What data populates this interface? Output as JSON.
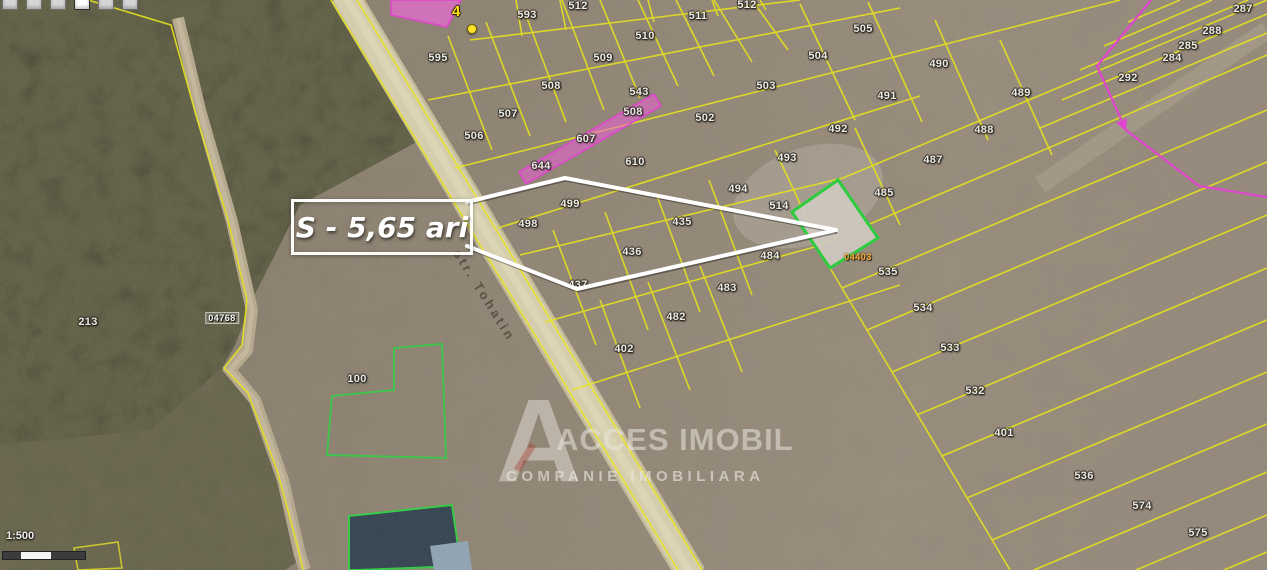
{
  "toolbar": {
    "buttons": [
      {
        "active": false
      },
      {
        "active": false
      },
      {
        "active": false
      },
      {
        "active": true
      },
      {
        "active": false
      },
      {
        "active": false
      }
    ]
  },
  "map": {
    "annotation": {
      "text": "S - 5,65 ari"
    },
    "street_label": {
      "text": "str. Tohatin"
    },
    "marker": {
      "text": "4"
    },
    "scale": {
      "label": "1:500"
    },
    "watermark": {
      "logo_letter": "A",
      "title": "ACCES IMOBIL",
      "subtitle": "COMPANIE IMOBILIARA"
    },
    "cadastral_labels": [
      {
        "text": "04768",
        "x": 222,
        "y": 318,
        "style": "chip"
      },
      {
        "text": "04403",
        "x": 858,
        "y": 257,
        "style": "orange"
      }
    ],
    "parcel_labels": [
      {
        "text": "593",
        "x": 527,
        "y": 15
      },
      {
        "text": "512",
        "x": 578,
        "y": 6
      },
      {
        "text": "511",
        "x": 698,
        "y": 16
      },
      {
        "text": "512",
        "x": 747,
        "y": 5
      },
      {
        "text": "510",
        "x": 645,
        "y": 36
      },
      {
        "text": "509",
        "x": 603,
        "y": 58
      },
      {
        "text": "595",
        "x": 438,
        "y": 58
      },
      {
        "text": "508",
        "x": 551,
        "y": 86
      },
      {
        "text": "543",
        "x": 639,
        "y": 92
      },
      {
        "text": "507",
        "x": 508,
        "y": 114
      },
      {
        "text": "506",
        "x": 474,
        "y": 136
      },
      {
        "text": "508",
        "x": 633,
        "y": 112
      },
      {
        "text": "607",
        "x": 586,
        "y": 139
      },
      {
        "text": "644",
        "x": 541,
        "y": 166
      },
      {
        "text": "610",
        "x": 635,
        "y": 162
      },
      {
        "text": "502",
        "x": 705,
        "y": 118
      },
      {
        "text": "503",
        "x": 766,
        "y": 86
      },
      {
        "text": "504",
        "x": 818,
        "y": 56
      },
      {
        "text": "505",
        "x": 863,
        "y": 29
      },
      {
        "text": "490",
        "x": 939,
        "y": 64
      },
      {
        "text": "491",
        "x": 887,
        "y": 96
      },
      {
        "text": "492",
        "x": 838,
        "y": 129
      },
      {
        "text": "489",
        "x": 1021,
        "y": 93
      },
      {
        "text": "488",
        "x": 984,
        "y": 130
      },
      {
        "text": "487",
        "x": 933,
        "y": 160
      },
      {
        "text": "493",
        "x": 787,
        "y": 158
      },
      {
        "text": "494",
        "x": 738,
        "y": 189
      },
      {
        "text": "485",
        "x": 884,
        "y": 193
      },
      {
        "text": "514",
        "x": 779,
        "y": 206
      },
      {
        "text": "499",
        "x": 570,
        "y": 204
      },
      {
        "text": "498",
        "x": 528,
        "y": 224
      },
      {
        "text": "435",
        "x": 682,
        "y": 222
      },
      {
        "text": "436",
        "x": 632,
        "y": 252
      },
      {
        "text": "437",
        "x": 578,
        "y": 285
      },
      {
        "text": "484",
        "x": 770,
        "y": 256
      },
      {
        "text": "483",
        "x": 727,
        "y": 288
      },
      {
        "text": "482",
        "x": 676,
        "y": 317
      },
      {
        "text": "402",
        "x": 624,
        "y": 349
      },
      {
        "text": "535",
        "x": 888,
        "y": 272
      },
      {
        "text": "534",
        "x": 923,
        "y": 308
      },
      {
        "text": "533",
        "x": 950,
        "y": 348
      },
      {
        "text": "532",
        "x": 975,
        "y": 391
      },
      {
        "text": "401",
        "x": 1004,
        "y": 433
      },
      {
        "text": "536",
        "x": 1084,
        "y": 476
      },
      {
        "text": "574",
        "x": 1142,
        "y": 506
      },
      {
        "text": "575",
        "x": 1198,
        "y": 533
      },
      {
        "text": "213",
        "x": 88,
        "y": 322
      },
      {
        "text": "100",
        "x": 357,
        "y": 379
      },
      {
        "text": "287",
        "x": 1243,
        "y": 9
      },
      {
        "text": "288",
        "x": 1212,
        "y": 31
      },
      {
        "text": "285",
        "x": 1188,
        "y": 46
      },
      {
        "text": "284",
        "x": 1172,
        "y": 58
      },
      {
        "text": "292",
        "x": 1128,
        "y": 78
      }
    ],
    "colors": {
      "parcel_line": "#e8e41c",
      "selected_parcel_border": "#2ecc40",
      "magenta_overlay": "#e145cf",
      "annotation": "#ffffff",
      "road": "#d7cfad"
    }
  }
}
